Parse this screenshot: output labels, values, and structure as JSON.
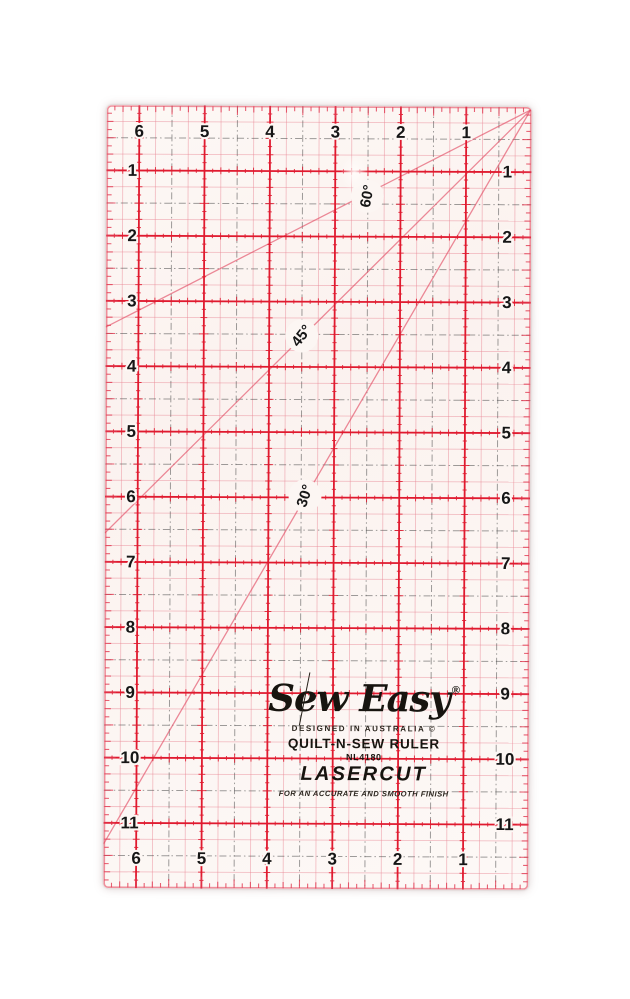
{
  "photo": {
    "background_color": "#ffffff"
  },
  "ruler": {
    "size_label": "6.5 x 12 inch grid ruler",
    "colors": {
      "grid_red": "#e01a2f",
      "diagonal_red": "#e34e66",
      "dash_gray": "#4f4f4f",
      "quarter_pink": "#e98795",
      "edge_tick_red": "#e23a52",
      "number_black": "#161616",
      "label_circle": "#fcf6f3",
      "plastic_tint": "#fdf7f4"
    },
    "numbers": {
      "top": [
        "6",
        "5",
        "4",
        "3",
        "2",
        "1"
      ],
      "bottom": [
        "6",
        "5",
        "4",
        "3",
        "2",
        "1"
      ],
      "left": [
        "1",
        "2",
        "3",
        "4",
        "5",
        "6",
        "7",
        "8",
        "9",
        "10",
        "11"
      ],
      "right": [
        "1",
        "2",
        "3",
        "4",
        "5",
        "6",
        "7",
        "8",
        "9",
        "10",
        "11"
      ]
    },
    "angle_labels": [
      {
        "text": "60°"
      },
      {
        "text": "45°"
      },
      {
        "text": "30°"
      }
    ],
    "branding": {
      "logo": "Sew Easy",
      "registered": "®",
      "origin": "DESIGNED IN AUSTRALIA ©",
      "product": "QUILT-N-SEW RULER",
      "model": "NL4180",
      "cut": "LASERCUT",
      "tagline": "FOR AN ACCURATE AND SMOOTH FINISH"
    }
  }
}
